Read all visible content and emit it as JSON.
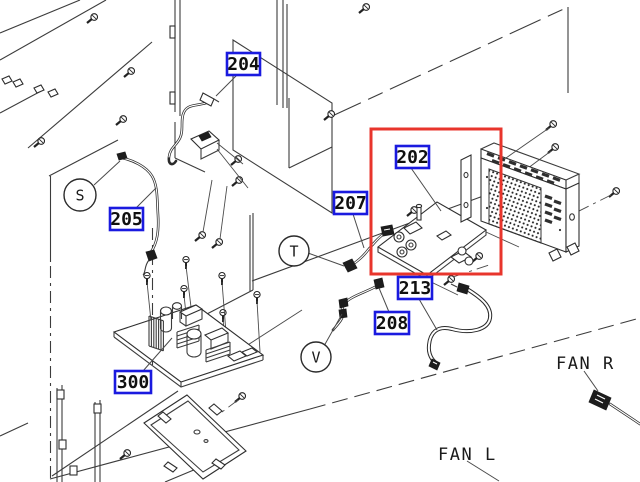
{
  "labels": {
    "p202": "202",
    "p204": "204",
    "p205": "205",
    "p207": "207",
    "p208": "208",
    "p213": "213",
    "p300": "300"
  },
  "callouts": {
    "s": "S",
    "t": "T",
    "v": "V"
  },
  "annotations": {
    "fan_r": "FAN R",
    "fan_l": "FAN L"
  },
  "colors": {
    "label_border": "#1a1adf",
    "highlight": "#e8352c",
    "line": "#3c3c3c",
    "text": "#101010",
    "background": "#ffffff"
  }
}
